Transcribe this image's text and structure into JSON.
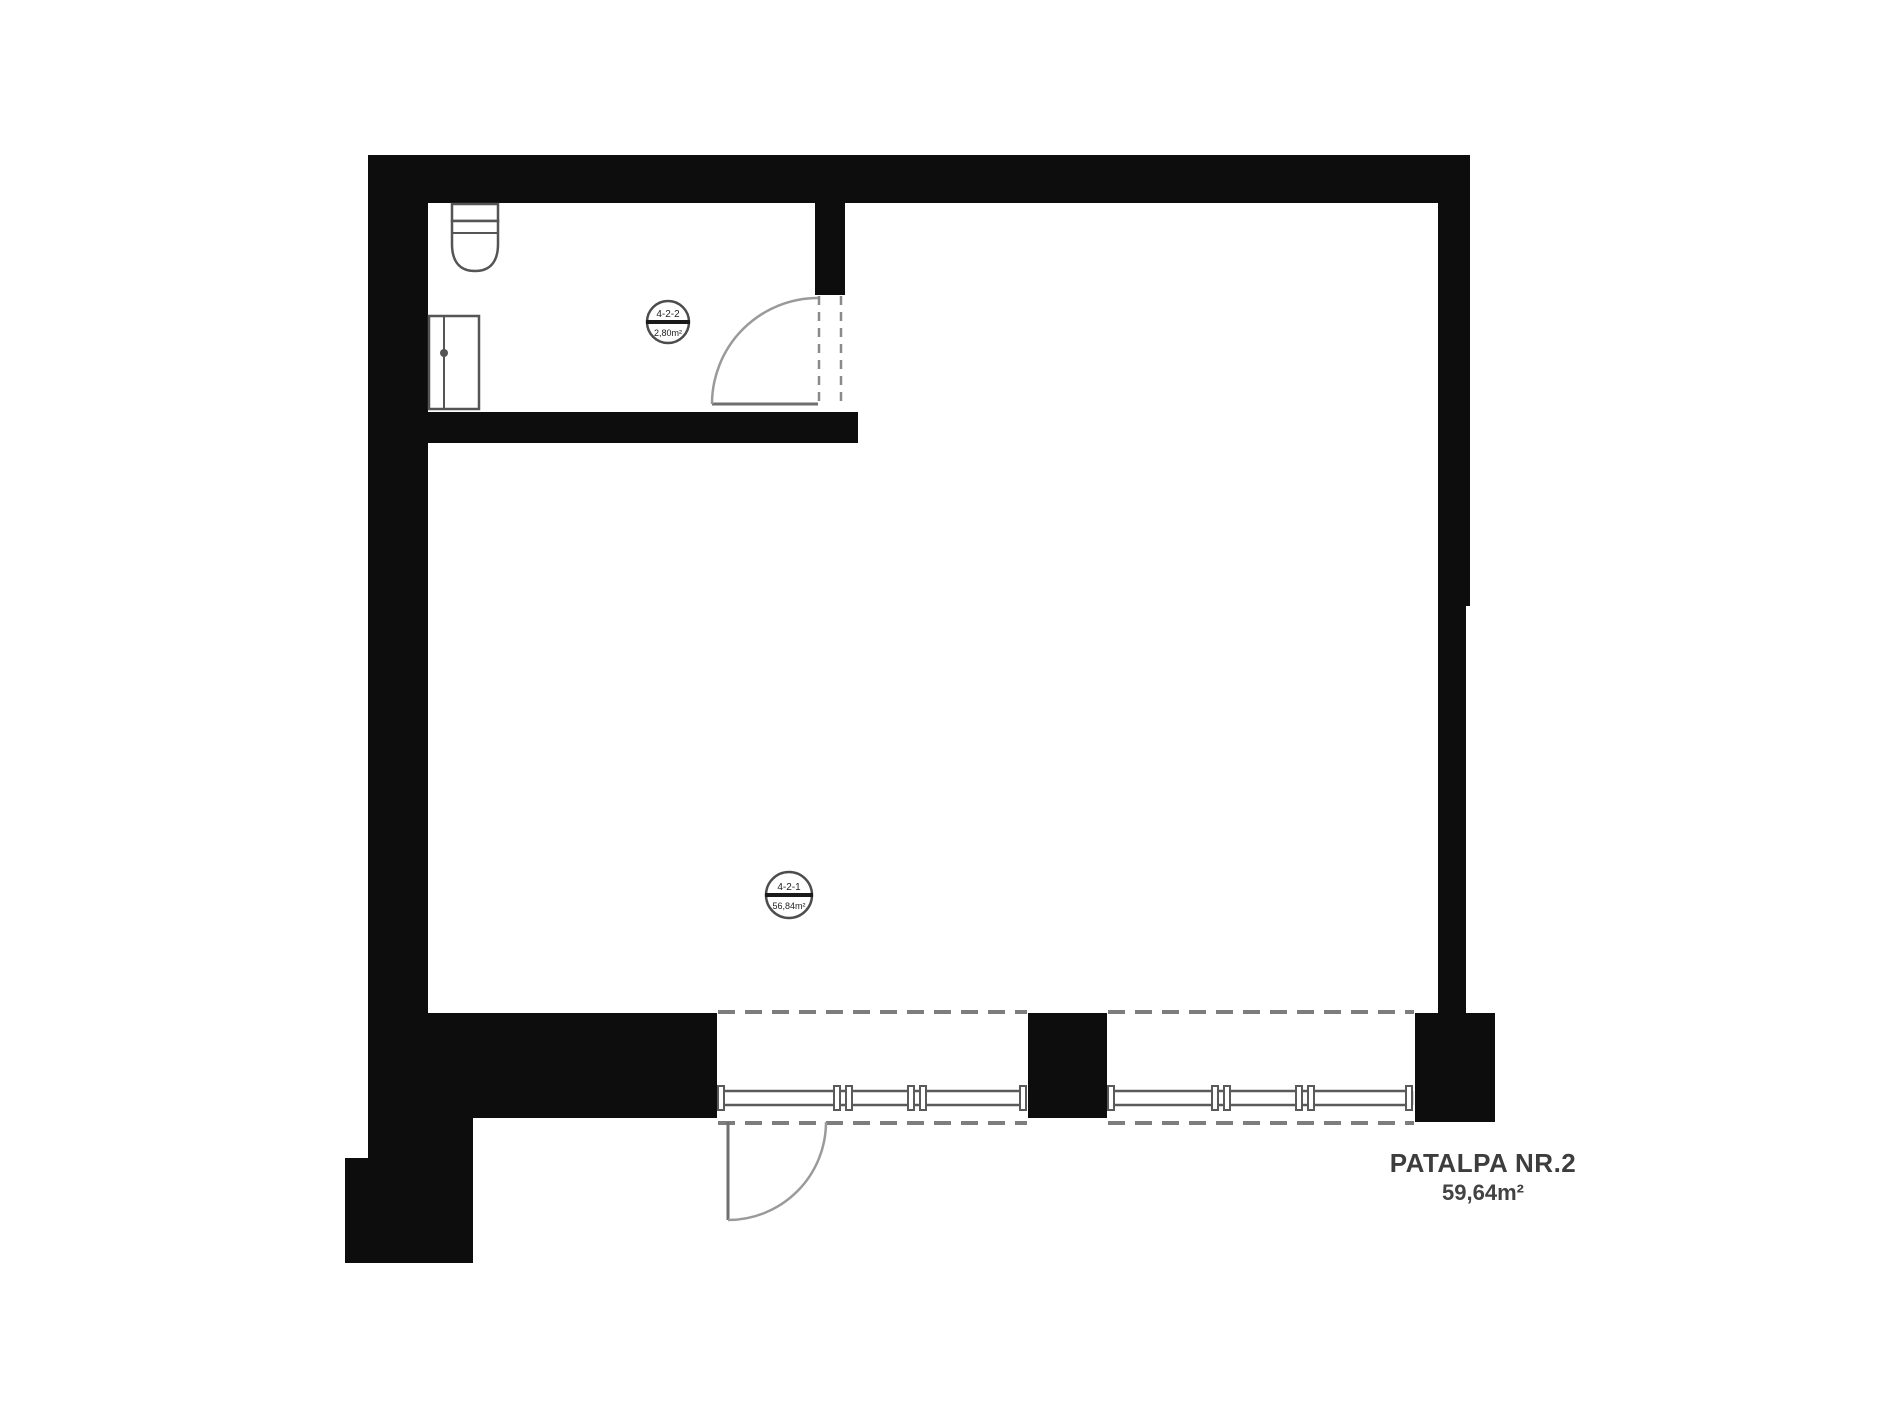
{
  "floorplan": {
    "label": {
      "title": "PATALPA NR.2",
      "area": "59,64m²"
    },
    "room_tags": [
      {
        "name": "main-room",
        "code": "4-2-1",
        "area": "56,84m²"
      },
      {
        "name": "bathroom",
        "code": "4-2-2",
        "area": "2,80m²"
      }
    ],
    "icons": {
      "toilet": "toilet-icon",
      "appliance": "appliance-icon"
    },
    "colors": {
      "wall": "#0d0d0d",
      "fixture_line": "#555555",
      "door_line": "#9a9a9a",
      "dashed_line": "#7d7d7d",
      "label_text": "#3d3d3d",
      "background": "#ffffff"
    }
  }
}
